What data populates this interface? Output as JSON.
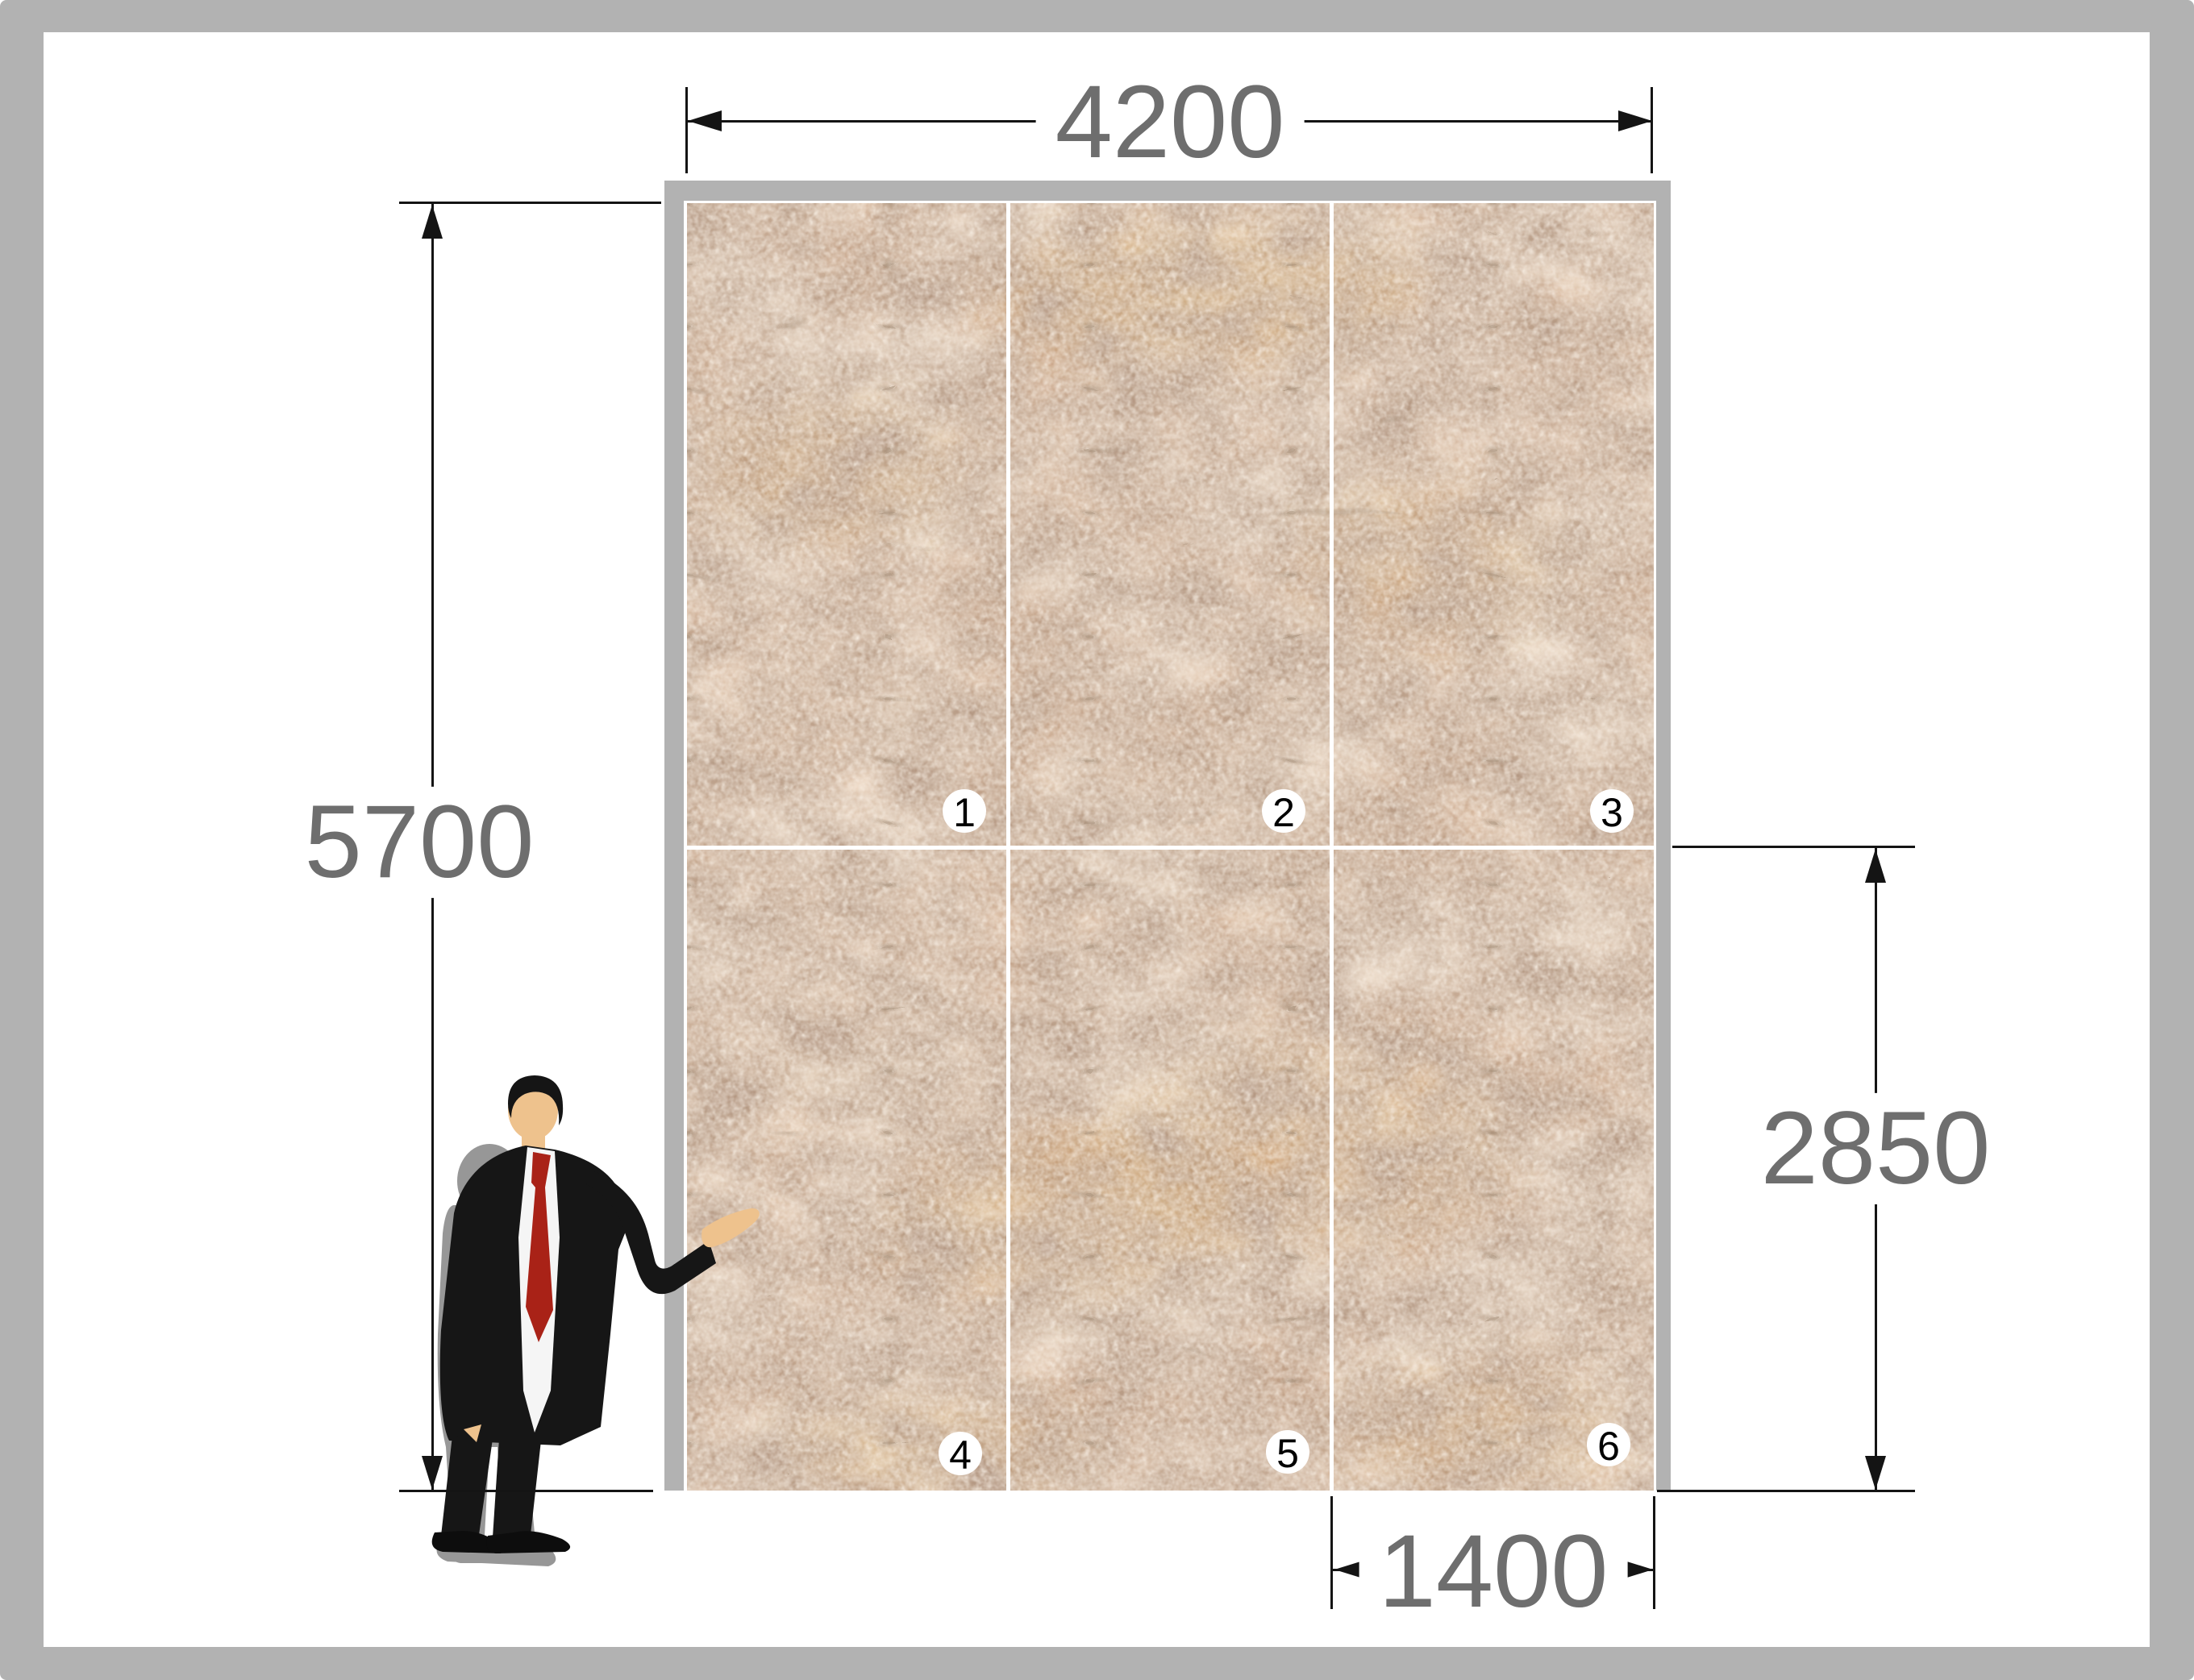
{
  "diagram": {
    "type": "stone-cladding-elevation",
    "wall": {
      "rows": 2,
      "columns": 3,
      "frame_color": "#b2b2b2",
      "panels": [
        {
          "number": "1"
        },
        {
          "number": "2"
        },
        {
          "number": "3"
        },
        {
          "number": "4"
        },
        {
          "number": "5"
        },
        {
          "number": "6"
        }
      ],
      "stone_colors": {
        "base": "#c49877",
        "light_patch": "#dcbfa4",
        "pale_speckle": "#ecdccb",
        "dark_mottle": "#7d5c44",
        "crack": "#5a3f2c",
        "ochre": "#c58a38"
      }
    },
    "dimensions": {
      "total_width": {
        "value": "4200"
      },
      "total_height": {
        "value": "5700"
      },
      "panel_height": {
        "value": "2850"
      },
      "panel_width": {
        "value": "1400"
      }
    },
    "figure": {
      "kind": "businessman-scale-silhouette",
      "suit": "#161616",
      "shirt": "#f5f5f5",
      "tie": "#a92217",
      "skin": "#eec28d",
      "shadow": "#979797"
    },
    "style": {
      "page_border": "#b2b2b2",
      "dimension_line": "#141414",
      "dimension_text": "#6e6e6e",
      "badge_bg": "#ffffff",
      "badge_text": "#000000"
    }
  }
}
